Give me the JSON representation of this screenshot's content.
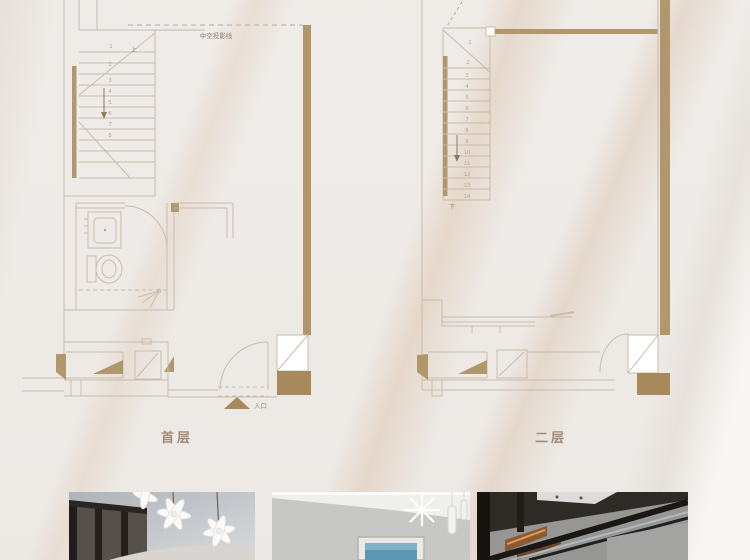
{
  "colors": {
    "wall_tan": "#b2976c",
    "wall_dark_tan": "#a7895b",
    "plan_line": "#c9bcaa",
    "plan_text": "#a18b79",
    "background": "#fbfaf8"
  },
  "floor_plans": {
    "first_floor": {
      "label": "首层",
      "void_projection_label": "中空投影线",
      "entrance_label": "入口",
      "stair_direction_label": "上",
      "stair_step_numbers": [
        "1",
        "2",
        "3",
        "4",
        "5",
        "6",
        "7",
        "8"
      ]
    },
    "second_floor": {
      "label": "二层",
      "stair_direction_label": "下",
      "stair_step_numbers": [
        "1",
        "2",
        "3",
        "4",
        "5",
        "6",
        "7",
        "8",
        "9",
        "10",
        "11",
        "12",
        "13",
        "14"
      ]
    }
  },
  "photo_gallery": {
    "photos": [
      {
        "depicts": "white petal chandelier in front of dark framed glass partition"
      },
      {
        "depicts": "grey hallway wall with framed blue artwork and pendant crystal lights"
      },
      {
        "depicts": "staircase with black framed glass balustrade and warm lit wood steps"
      }
    ]
  }
}
